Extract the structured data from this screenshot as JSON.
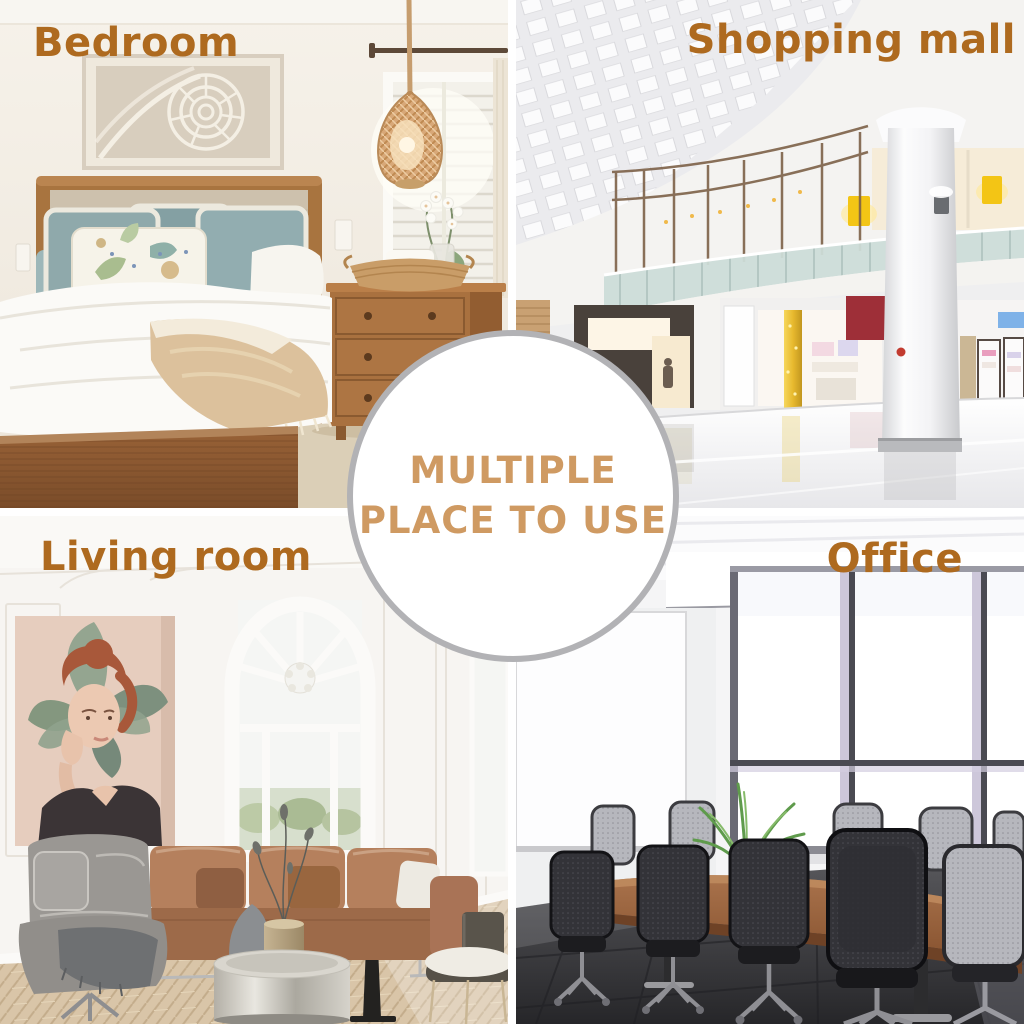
{
  "colors": {
    "label_brown": "#ae6a1f",
    "badge_text": "#cf9a62",
    "badge_border": "#b2b2b5",
    "badge_bg": "#ffffff",
    "gutter_white": "#ffffff"
  },
  "center_badge": {
    "line1": "MULTIPLE",
    "line2": "PLACE TO USE"
  },
  "quadrants": [
    {
      "id": "bedroom",
      "label": "Bedroom"
    },
    {
      "id": "shopping-mall",
      "label": "Shopping mall"
    },
    {
      "id": "living-room",
      "label": "Living room"
    },
    {
      "id": "office",
      "label": "Office"
    }
  ]
}
